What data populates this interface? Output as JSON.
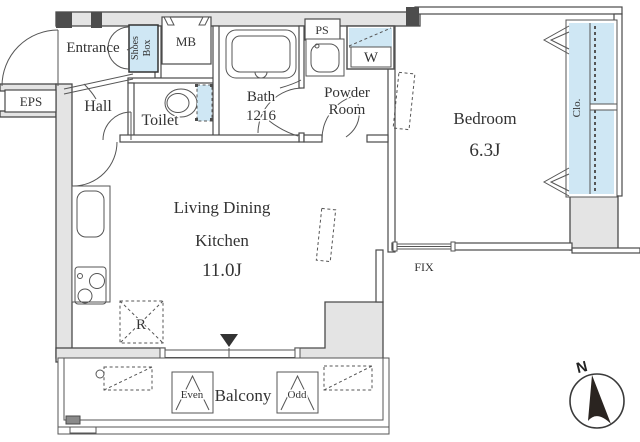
{
  "plan": {
    "colors": {
      "wall_fill": "#e4e4e4",
      "line": "#4a4a4a",
      "highlight_blue": "#cfe7f4",
      "text": "#333333"
    },
    "labels": {
      "entrance": "Entrance",
      "shoes_line1": "Shoes",
      "shoes_line2": "Box",
      "mb": "MB",
      "eps": "EPS",
      "hall": "Hall",
      "toilet": "Toilet",
      "bath": "Bath",
      "bath_size": "1216",
      "ps": "PS",
      "powder_line1": "Powder",
      "powder_line2": "Room",
      "washer": "W",
      "bedroom": "Bedroom",
      "bedroom_size": "6.3J",
      "closet": "Clo.",
      "living_line1": "Living Dining",
      "living_line2": "Kitchen",
      "living_size": "11.0J",
      "fix_window": "FIX",
      "fridge": "R",
      "balcony": "Balcony",
      "even": "Even",
      "odd": "Odd",
      "north": "N"
    }
  }
}
